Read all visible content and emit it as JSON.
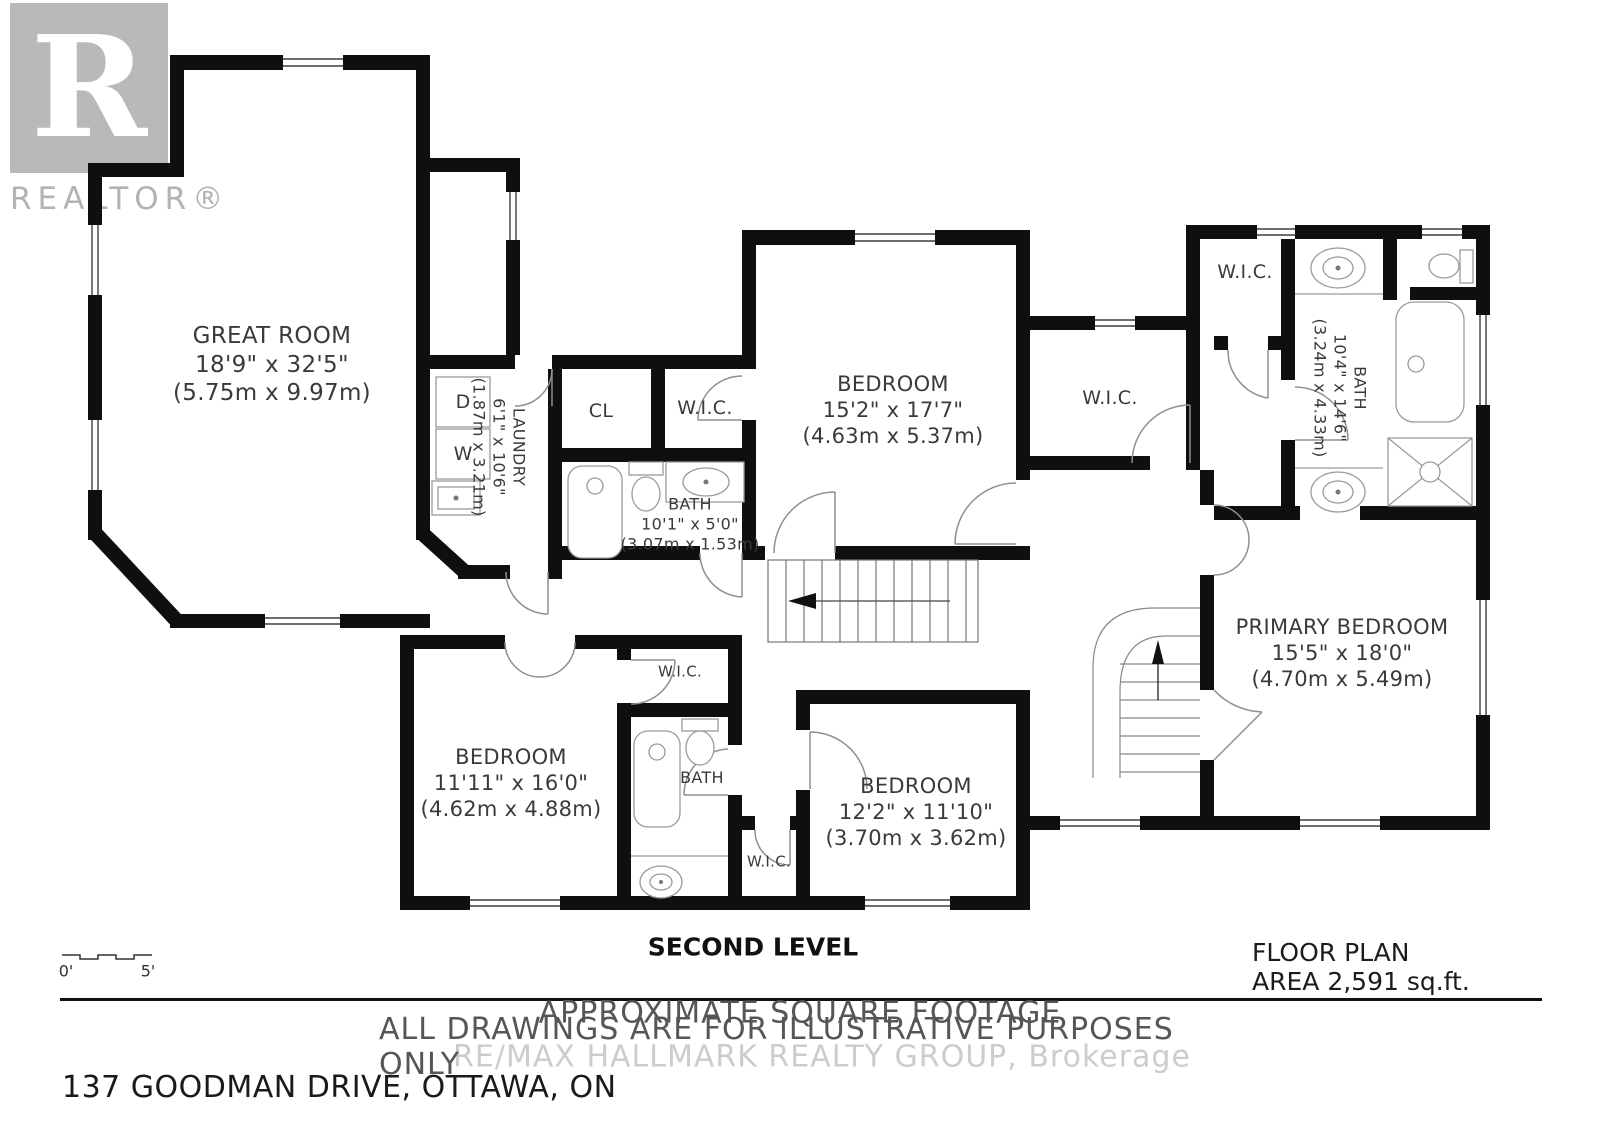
{
  "branding": {
    "logo_letter": "R",
    "logo_text": "REALTOR®",
    "watermark": "RE/MAX HALLMARK REALTY GROUP, Brokerage"
  },
  "rooms": {
    "great_room": {
      "name": "GREAT ROOM",
      "imperial": "18'9\" x 32'5\"",
      "metric": "(5.75m x 9.97m)"
    },
    "laundry": {
      "name": "LAUNDRY",
      "imperial": "6'1\" x 10'6\"",
      "metric": "(1.87m x 3.21m)"
    },
    "closet": {
      "name": "CL"
    },
    "wic_hall": {
      "name": "W.I.C."
    },
    "bath_hall": {
      "name": "BATH",
      "imperial": "10'1\" x 5'0\"",
      "metric": "(3.07m x 1.53m)"
    },
    "bedroom_top": {
      "name": "BEDROOM",
      "imperial": "15'2\" x 17'7\"",
      "metric": "(4.63m x 5.37m)"
    },
    "wic_middle": {
      "name": "W.I.C."
    },
    "wic_primary": {
      "name": "W.I.C."
    },
    "bath_primary": {
      "name": "BATH",
      "imperial": "10'4\" x 14'6\"",
      "metric": "(3.24m x 4.33m)"
    },
    "primary_bedroom": {
      "name": "PRIMARY BEDROOM",
      "imperial": "15'5\" x 18'0\"",
      "metric": "(4.70m x 5.49m)"
    },
    "bedroom_left": {
      "name": "BEDROOM",
      "imperial": "11'11\" x 16'0\"",
      "metric": "(4.62m x 4.88m)"
    },
    "wic_small": {
      "name": "W.I.C."
    },
    "bath_lower": {
      "name": "BATH"
    },
    "bedroom_lower": {
      "name": "BEDROOM",
      "imperial": "12'2\" x 11'10\"",
      "metric": "(3.70m x 3.62m)"
    },
    "wic_lower": {
      "name": "W.I.C."
    }
  },
  "appliances": {
    "dryer": "D",
    "washer": "W"
  },
  "plan": {
    "level_title": "SECOND LEVEL",
    "area_note": "FLOOR PLAN AREA 2,591 sq.ft.",
    "disclaimer_line1": "APPROXIMATE SQUARE FOOTAGE",
    "disclaimer_line2": "ALL DRAWINGS ARE FOR ILLUSTRATIVE PURPOSES ONLY",
    "address": "137 GOODMAN DRIVE, OTTAWA, ON",
    "scale_start": "0'",
    "scale_end": "5'"
  },
  "colors": {
    "wall": "#0f0f0f",
    "label": "#3a3a3a",
    "watermark": "#cccccc",
    "logo_gray": "#b9b9b9"
  }
}
